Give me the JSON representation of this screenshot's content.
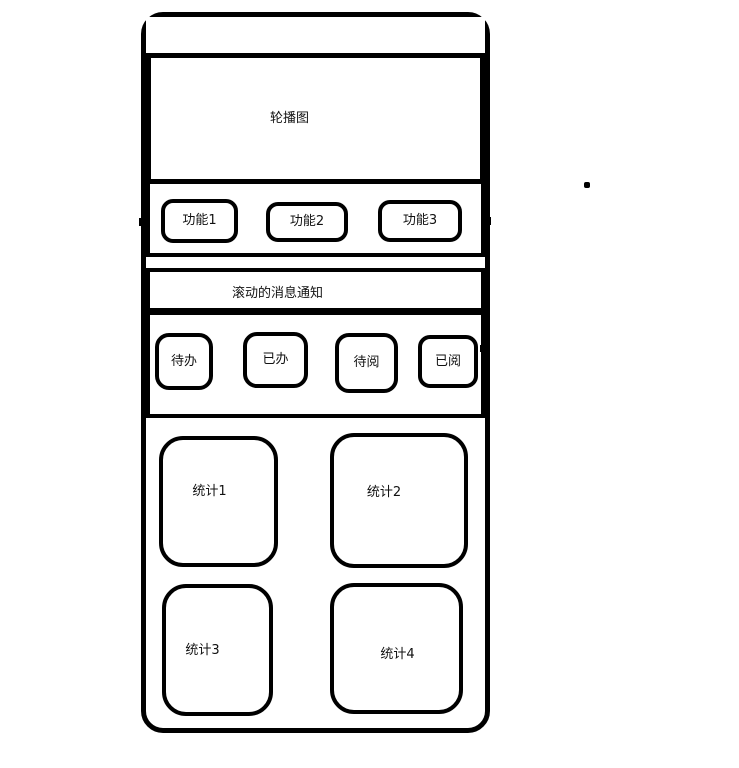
{
  "colors": {
    "background": "#ffffff",
    "stroke": "#000000",
    "text": "#111111"
  },
  "phone": {
    "carousel": {
      "label": "轮播图"
    },
    "function_row": {
      "buttons": [
        {
          "label": "功能1"
        },
        {
          "label": "功能2"
        },
        {
          "label": "功能3"
        }
      ]
    },
    "notice_bar": {
      "label": "滚动的消息通知"
    },
    "action_row": {
      "buttons": [
        {
          "label": "待办"
        },
        {
          "label": "已办"
        },
        {
          "label": "待阅"
        },
        {
          "label": "已阅"
        }
      ]
    },
    "stats": {
      "cards": [
        {
          "label": "统计1"
        },
        {
          "label": "统计2"
        },
        {
          "label": "统计3"
        },
        {
          "label": "统计4"
        }
      ]
    }
  }
}
